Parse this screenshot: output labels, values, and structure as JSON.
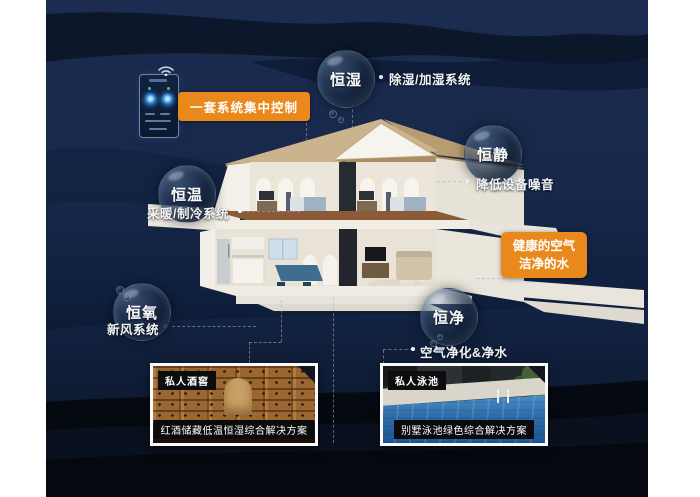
{
  "poster": {
    "control": {
      "label": "一套系统集中控制"
    },
    "bubbles": [
      {
        "label": "恒湿",
        "desc": "除湿/加湿系统"
      },
      {
        "label": "恒静",
        "desc": "降低设备噪音"
      },
      {
        "label": "恒温",
        "desc": "采暖/制冷系统"
      },
      {
        "label": "恒氧",
        "desc": "新风系统"
      },
      {
        "label": "恒净",
        "desc": "空气净化&净水"
      }
    ],
    "highlight": {
      "line1": "健康的空气",
      "line2": "洁净的水"
    },
    "photos": [
      {
        "tag": "私人酒窖",
        "caption": "红酒储藏低温恒湿综合解决方案"
      },
      {
        "tag": "私人泳池",
        "caption": "别墅泳池绿色综合解决方案"
      }
    ],
    "colors": {
      "accent": "#E9891C",
      "panel": "#17284A",
      "text": "#F2F4F7"
    }
  }
}
